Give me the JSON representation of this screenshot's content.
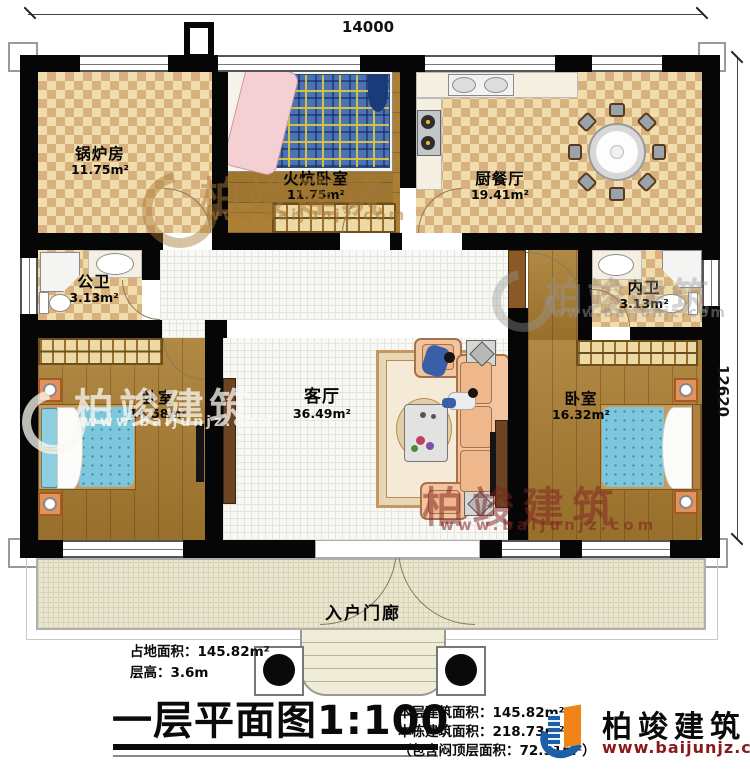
{
  "dimensions": {
    "width_label": "14000",
    "height_label": "12620"
  },
  "rooms": {
    "boiler": {
      "name": "锅炉房",
      "area": "11.75m²"
    },
    "kang_bedroom": {
      "name": "火炕卧室",
      "area": "11.75m²"
    },
    "kitchen_dining": {
      "name": "厨餐厅",
      "area": "19.41m²"
    },
    "public_bath": {
      "name": "公卫",
      "area": "3.13m²"
    },
    "bedroom_left": {
      "name": "卧室",
      "area": "14.58m²"
    },
    "living": {
      "name": "客厅",
      "area": "36.49m²"
    },
    "private_bath": {
      "name": "内卫",
      "area": "3.13m²"
    },
    "bedroom_right": {
      "name": "卧室",
      "area": "16.32m²"
    },
    "porch": {
      "name": "入户门廊"
    }
  },
  "info_left": {
    "line1": "占地面积：145.82m²",
    "line2": "层高：3.6m"
  },
  "title": {
    "text": "一层平面图",
    "scale": "1:100"
  },
  "info_right": {
    "line1": "本层建筑面积：145.82m²",
    "line2": "本栋建筑面积：218.73m²",
    "line3": "（包含闷顶层面积：72.91m²）"
  },
  "brand": {
    "name": "柏竣建筑",
    "url": "www.baijunjz.com"
  },
  "watermark": {
    "name": "柏竣建筑",
    "url": "www.baijunjz.com"
  },
  "colors": {
    "wall": "#060606",
    "checker_dark": "#d8b27e",
    "wood": "#a87c30",
    "tile": "#f8f8f5",
    "porch": "#eae6cf",
    "bed_teal": "#7cc7dc",
    "kang_blue": "#4a73b5",
    "sofa_peach": "#f2c5a0",
    "brand_blue": "#1a5fa8",
    "brand_orange": "#f08418",
    "brand_red": "#8b1818"
  }
}
